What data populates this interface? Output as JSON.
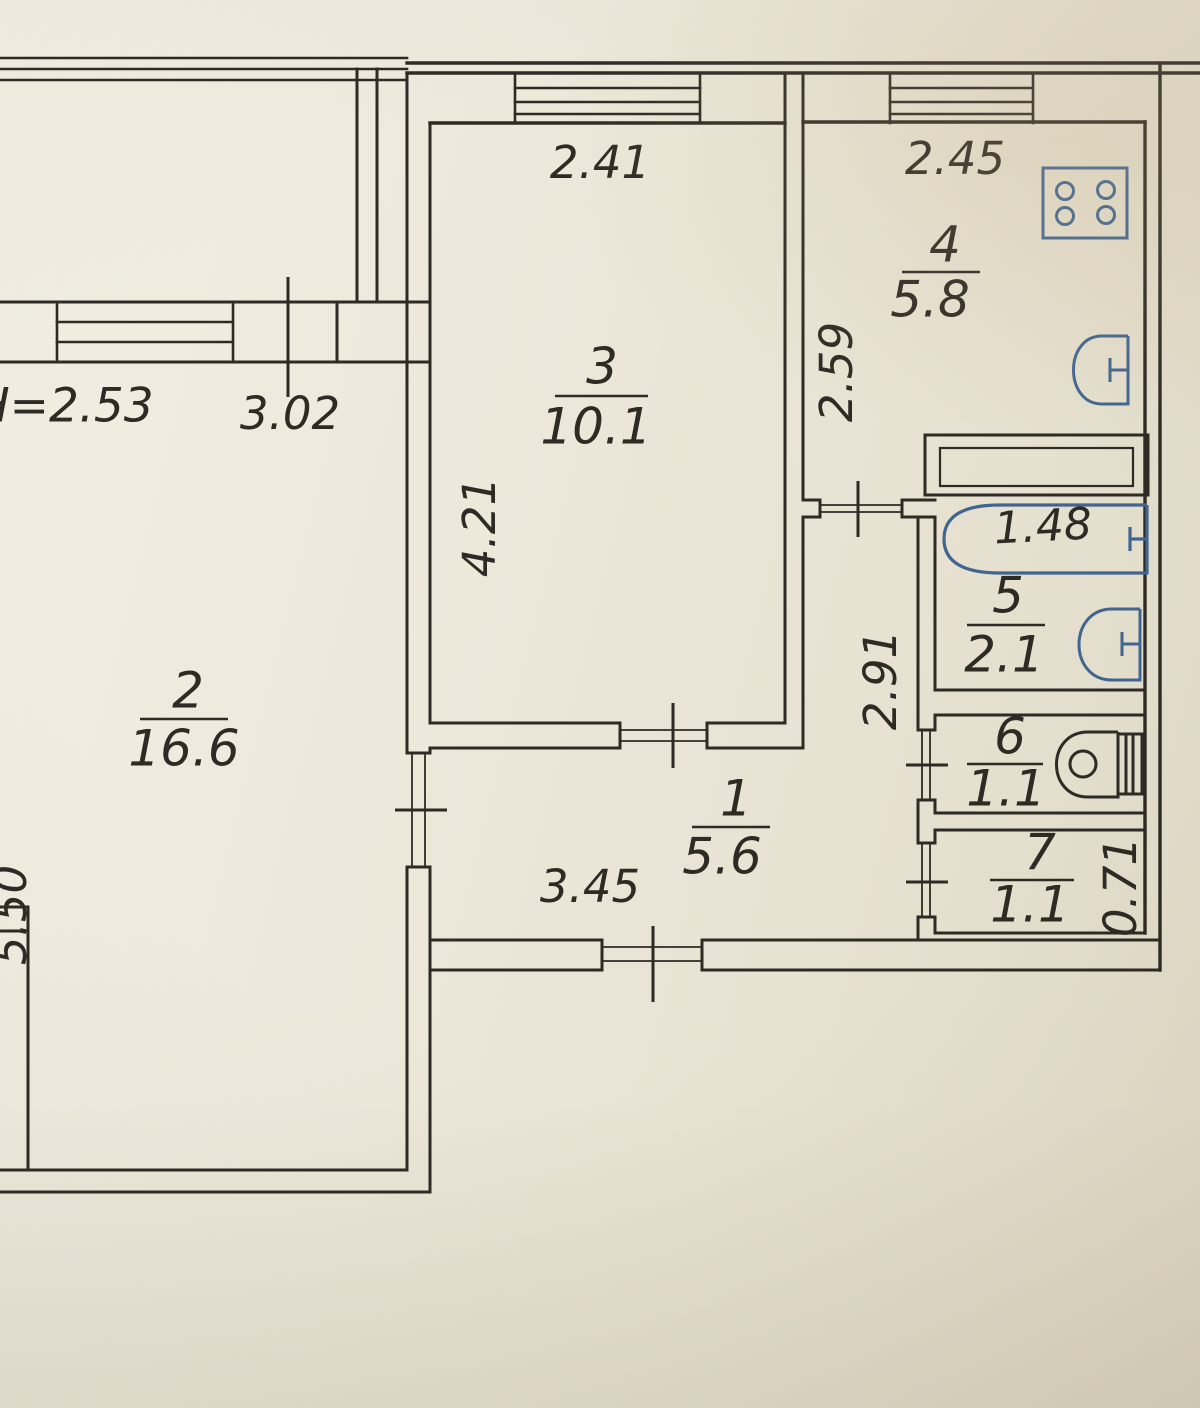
{
  "plan": {
    "type": "apartment-floor-plan-scan",
    "height_note": "H=2.53",
    "rooms": {
      "r1": {
        "number": "1",
        "area": "5.6"
      },
      "r2": {
        "number": "2",
        "area": "16.6"
      },
      "r3": {
        "number": "3",
        "area": "10.1"
      },
      "r4": {
        "number": "4",
        "area": "5.8"
      },
      "r5": {
        "number": "5",
        "area": "2.1"
      },
      "r6": {
        "number": "6",
        "area": "1.1"
      },
      "r7": {
        "number": "7",
        "area": "1.1"
      }
    },
    "dims": {
      "room3_width": "2.41",
      "kitchen_width": "2.45",
      "room2_width": "3.02",
      "room3_depth": "4.21",
      "kitchen_depth": "2.59",
      "corridor_depth": "2.91",
      "bathtub_length": "1.48",
      "hall_width": "3.45",
      "room7_depth": "0.71",
      "room2_depth": "5.50"
    },
    "fixtures": {
      "stove": "gas-stove-4-burner",
      "kitchen_sink": "kitchen-sink",
      "bathtub": "bathtub",
      "bath_sink": "washbasin",
      "toilet": "toilet"
    },
    "colors": {
      "paper": "#e9e4d4",
      "ink": "#2e2a24",
      "blue_ink": "#2f5f9f",
      "fixture_blue": "#42658f"
    }
  }
}
